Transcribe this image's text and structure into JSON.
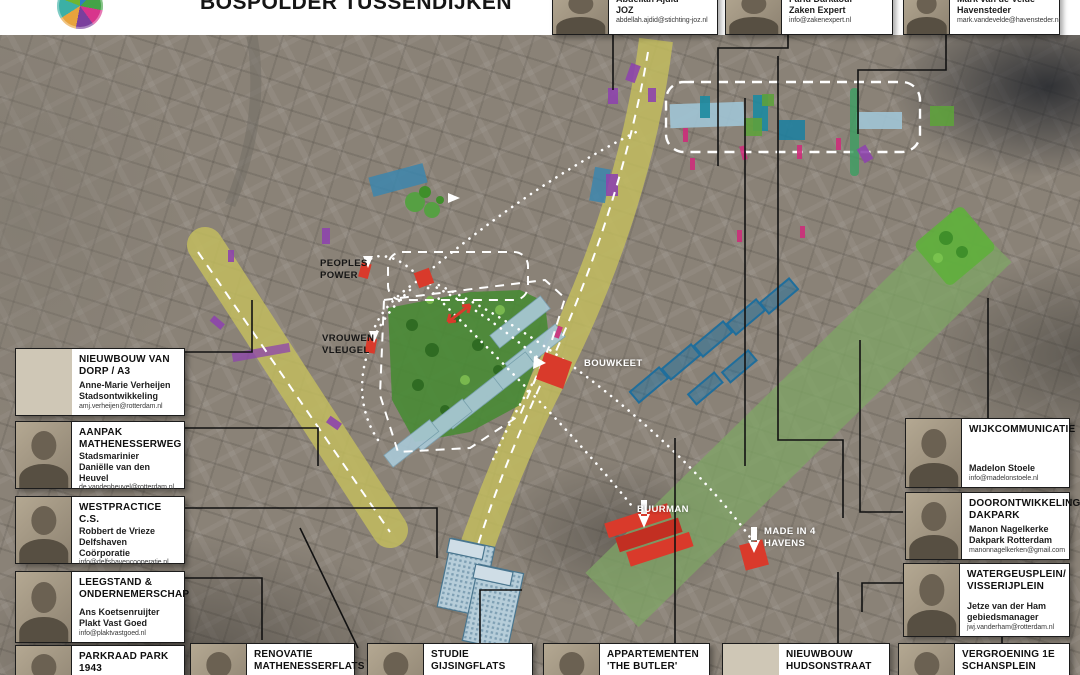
{
  "header": {
    "title": "BOSPOLDER TUSSENDIJKEN",
    "logo": "bospolder-tussendijken-logo"
  },
  "map_labels": {
    "peoples_power": "PEOPLES POWER",
    "vrouwen_vleugel": "VROUWEN VLEUGEL",
    "bouwkeet": "BOUWKEET",
    "buurman": "BUURMAN",
    "made_in_4_havens": "MADE IN 4 HAVENS"
  },
  "colors": {
    "accent_red": "#d93a2b",
    "street_yellow": "#c2bc5e",
    "park_green": "#4a8a36",
    "dakpark_green": "#7fa465",
    "building_blue": "#a9c8d6",
    "deep_blue": "#1f6e9c",
    "purple": "#8e44ad",
    "magenta": "#cc2f7b"
  },
  "callouts": {
    "top": [
      {
        "name": "Abdellah Ajdid",
        "org": "JOZ",
        "email": "abdellah.ajdid@stichting-joz.nl"
      },
      {
        "name": "Farid Darkaoui",
        "org": "Zaken Expert",
        "email": "info@zakenexpert.nl"
      },
      {
        "name": "Mark van de Velde",
        "org": "Havensteder",
        "email": "mark.vandevelde@havensteder.nl"
      }
    ],
    "left": [
      {
        "title": "NIEUWBOUW VAN DORP / A3",
        "name": "Anne-Marie Verheijen",
        "org": "Stadsontwikkeling",
        "email": "amj.verheijen@rotterdam.nl"
      },
      {
        "title": "AANPAK MATHENESSERWEG",
        "name": "Stadsmarinier",
        "org": "Daniëlle van den Heuvel",
        "email": "de.vandenheuvel@rotterdam.nl"
      },
      {
        "title": "WESTPRACTICE C.S.",
        "name": "Robbert de Vrieze",
        "org": "Delfshaven Coörporatie",
        "email": "info@delfshavencooperatie.nl"
      },
      {
        "title": "LEEGSTAND & ONDERNEMERSCHAP",
        "name": "Ans Koetsenruijter",
        "org": "Plakt Vast Goed",
        "email": "info@plaktvastgoed.nl"
      }
    ],
    "right": [
      {
        "title": "WIJKCOMMUNICATIE",
        "name": "Madelon Stoele",
        "org": "",
        "email": "info@madelonstoele.nl"
      },
      {
        "title": "DOORONTWIKKELING DAKPARK",
        "name": "Manon Nagelkerke",
        "org": "Dakpark Rotterdam",
        "email": "manonnagelkerken@gmail.com"
      },
      {
        "title": "WATERGEUSPLEIN/ VISSERIJPLEIN",
        "name": "Jetze van der Ham",
        "org": "gebiedsmanager",
        "email": "jwj.vanderham@rotterdam.nl"
      }
    ],
    "bottom": [
      {
        "title": "PARKRAAD PARK 1943"
      },
      {
        "title": "RENOVATIE MATHENESSERFLATS"
      },
      {
        "title": "STUDIE GIJSINGFLATS"
      },
      {
        "title": "APPARTEMENTEN 'THE BUTLER'"
      },
      {
        "title": "NIEUWBOUW HUDSONSTRAAT"
      },
      {
        "title": "VERGROENING 1E SCHANSPLEIN"
      }
    ]
  }
}
